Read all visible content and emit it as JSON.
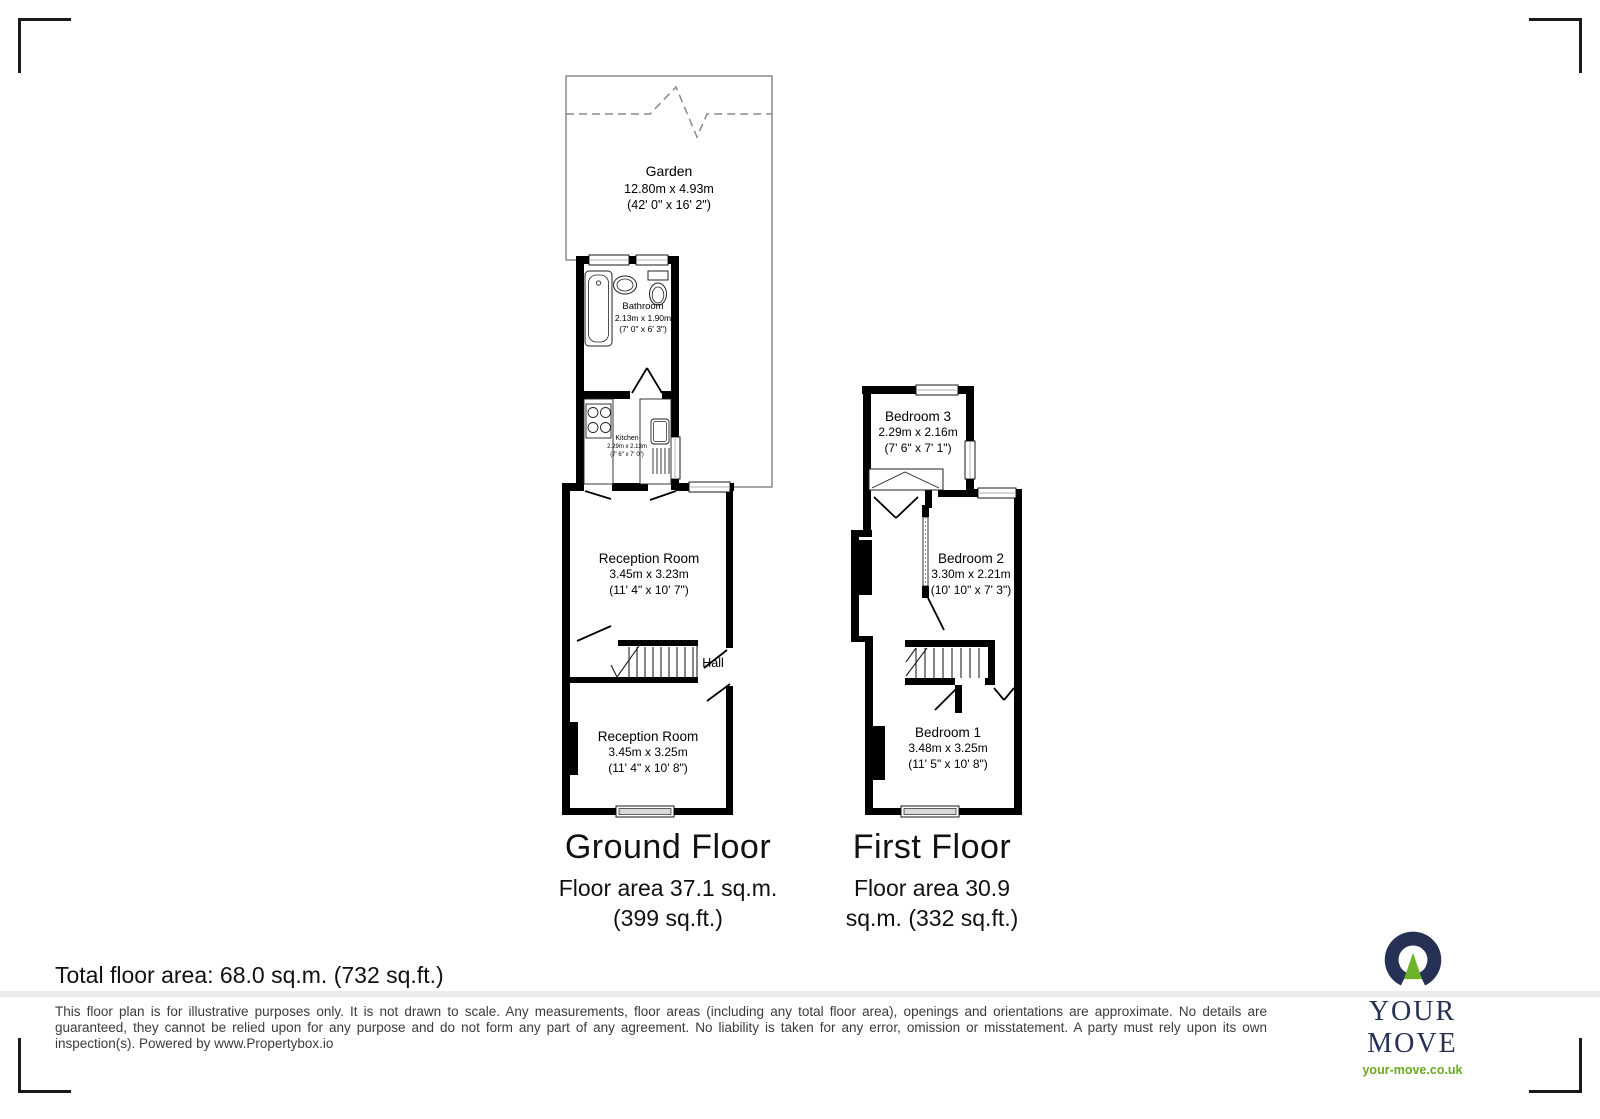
{
  "plan": {
    "garden": {
      "name": "Garden",
      "metric": "12.80m x 4.93m",
      "imperial": "(42' 0\" x 16' 2\")"
    },
    "bathroom": {
      "name": "Bathroom",
      "metric": "2.13m x 1.90m",
      "imperial": "(7' 0\" x 6' 3\")"
    },
    "kitchen": {
      "name": "Kitchen",
      "metric": "2.29m x 2.13m",
      "imperial": "(7' 6\" x 7' 0\")"
    },
    "reception1": {
      "name": "Reception Room",
      "metric": "3.45m x 3.23m",
      "imperial": "(11' 4\" x 10' 7\")"
    },
    "hall": {
      "name": "Hall"
    },
    "reception2": {
      "name": "Reception Room",
      "metric": "3.45m x 3.25m",
      "imperial": "(11' 4\" x 10' 8\")"
    },
    "bedroom3": {
      "name": "Bedroom 3",
      "metric": "2.29m x 2.16m",
      "imperial": "(7' 6\" x 7' 1\")"
    },
    "bedroom2": {
      "name": "Bedroom 2",
      "metric": "3.30m x 2.21m",
      "imperial": "(10' 10\" x 7' 3\")"
    },
    "bedroom1": {
      "name": "Bedroom 1",
      "metric": "3.48m x 3.25m",
      "imperial": "(11' 5\" x 10' 8\")"
    }
  },
  "floors": {
    "ground": {
      "title": "Ground Floor",
      "area_line1": "Floor area 37.1 sq.m.",
      "area_line2": "(399 sq.ft.)"
    },
    "first": {
      "title": "First Floor",
      "area_line1": "Floor area 30.9",
      "area_line2": "sq.m. (332 sq.ft.)"
    }
  },
  "footer": {
    "total_area": "Total floor area: 68.0 sq.m. (732 sq.ft.)",
    "disclaimer": "This floor plan is for illustrative purposes only. It is not drawn to scale. Any measurements, floor areas (including any total floor area), openings and orientations are approximate. No details are guaranteed, they cannot be relied upon for any purpose and do not form any part of any agreement. No liability is taken for any error, omission or misstatement. A party must rely upon its own inspection(s). Powered by www.Propertybox.io"
  },
  "logo": {
    "brand": "YOUR MOVE",
    "website": "your-move.co.uk",
    "navy": "#273156",
    "green": "#6cb32a"
  }
}
